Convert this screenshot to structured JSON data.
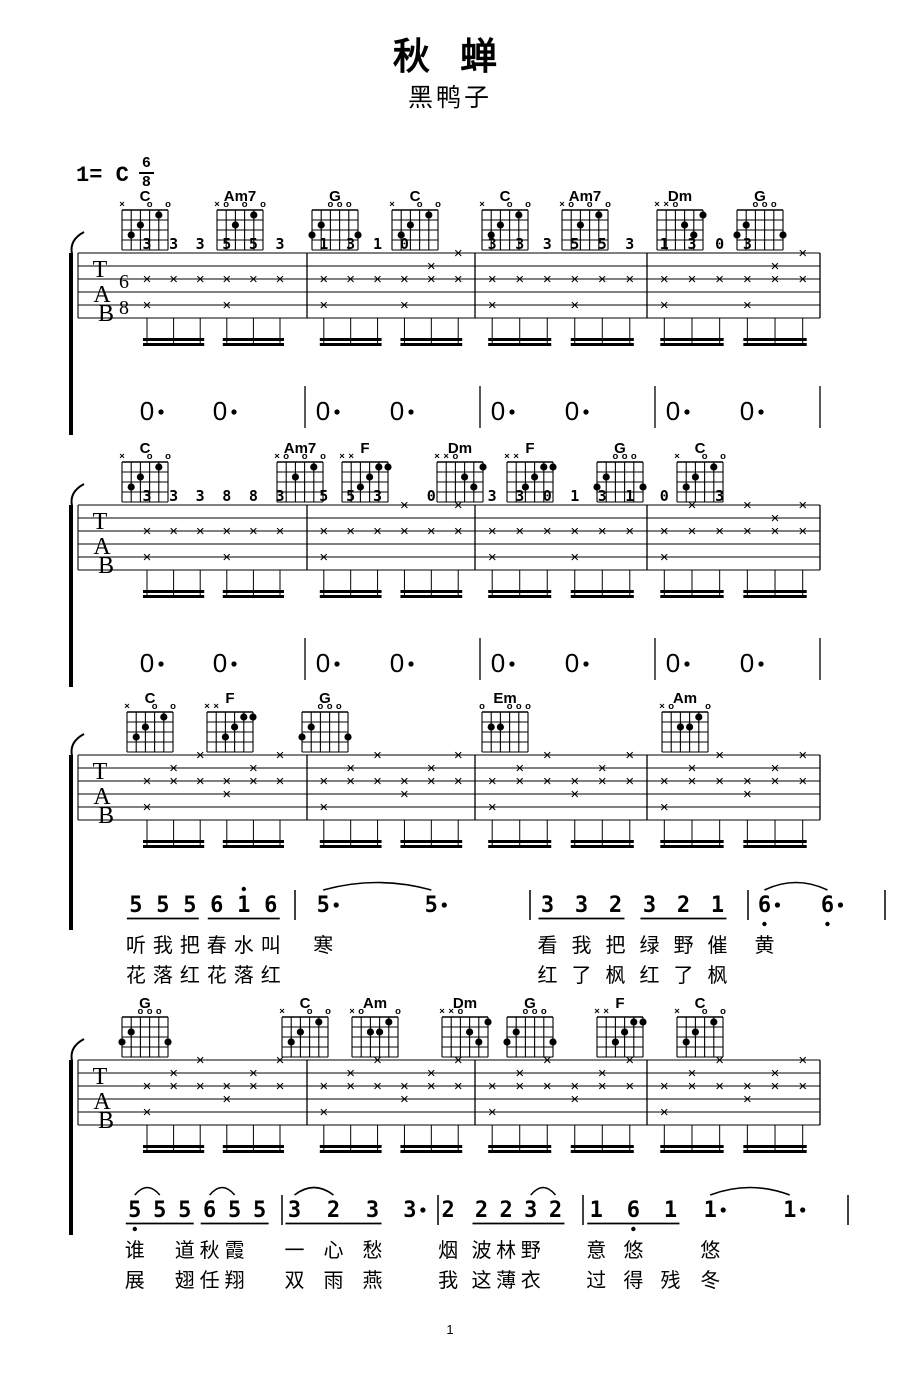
{
  "title": "秋 蝉",
  "artist": "黑鸭子",
  "key": {
    "prefix": "1= C",
    "time_numerator": "6",
    "time_denominator": "8"
  },
  "staff_labels": [
    "T",
    "A",
    "B"
  ],
  "strum_glyph": "×",
  "page_number": "1",
  "colors": {
    "ink": "#000000",
    "paper": "#ffffff"
  },
  "chord_shapes": {
    "C": {
      "markers": [
        "x",
        "",
        "",
        "o",
        "",
        "o"
      ],
      "dots": [
        [
          2,
          3
        ],
        [
          3,
          2
        ],
        [
          5,
          1
        ]
      ]
    },
    "Am7": {
      "markers": [
        "x",
        "o",
        "",
        "o",
        "",
        "o"
      ],
      "dots": [
        [
          3,
          2
        ],
        [
          5,
          1
        ]
      ]
    },
    "G": {
      "markers": [
        "",
        "",
        "o",
        "o",
        "o",
        ""
      ],
      "dots": [
        [
          1,
          3
        ],
        [
          2,
          2
        ],
        [
          6,
          3
        ]
      ]
    },
    "Dm": {
      "markers": [
        "x",
        "x",
        "o",
        "",
        "",
        ""
      ],
      "dots": [
        [
          4,
          2
        ],
        [
          5,
          3
        ],
        [
          6,
          1
        ]
      ]
    },
    "F": {
      "markers": [
        "x",
        "x",
        "",
        "",
        "",
        ""
      ],
      "dots": [
        [
          3,
          3
        ],
        [
          4,
          2
        ],
        [
          5,
          1
        ],
        [
          6,
          1
        ]
      ]
    },
    "Em": {
      "markers": [
        "o",
        "",
        "",
        "o",
        "o",
        "o"
      ],
      "dots": [
        [
          2,
          2
        ],
        [
          3,
          2
        ]
      ]
    },
    "Am": {
      "markers": [
        "x",
        "o",
        "",
        "",
        "",
        "o"
      ],
      "dots": [
        [
          3,
          2
        ],
        [
          4,
          2
        ],
        [
          5,
          1
        ]
      ]
    }
  },
  "systems": [
    {
      "name": "system-1",
      "chords": [
        {
          "name": "C",
          "x": 145
        },
        {
          "name": "Am7",
          "x": 240
        },
        {
          "name": "G",
          "x": 335
        },
        {
          "name": "C",
          "x": 415
        },
        {
          "name": "C",
          "x": 505
        },
        {
          "name": "Am7",
          "x": 585
        },
        {
          "name": "Dm",
          "x": 680
        },
        {
          "name": "G",
          "x": 760
        }
      ],
      "pattern": "arp",
      "digits": [
        [
          "3",
          "3",
          "3",
          "5",
          "5",
          "3"
        ],
        [
          "1",
          "3",
          "1",
          "0",
          "",
          ""
        ],
        [
          "3",
          "3",
          "3",
          "5",
          "5",
          "3"
        ],
        [
          "1",
          "3",
          "0",
          "3",
          "",
          ""
        ]
      ],
      "lower": {
        "type": "rests",
        "symbol": "0·",
        "per_measure": 2
      }
    },
    {
      "name": "system-2",
      "chords": [
        {
          "name": "C",
          "x": 145
        },
        {
          "name": "Am7",
          "x": 300
        },
        {
          "name": "F",
          "x": 365
        },
        {
          "name": "Dm",
          "x": 460
        },
        {
          "name": "F",
          "x": 530
        },
        {
          "name": "G",
          "x": 620
        },
        {
          "name": "C",
          "x": 700
        }
      ],
      "pattern": "arp",
      "digits": [
        [
          "3",
          "3",
          "3",
          "8",
          "8",
          "3"
        ],
        [
          "5",
          "5",
          "3",
          "",
          "0",
          ""
        ],
        [
          "3",
          "3",
          "0",
          "1",
          "3",
          "1"
        ],
        [
          "0",
          "",
          "3",
          "",
          "",
          ""
        ]
      ],
      "lower": {
        "type": "rests",
        "symbol": "0·",
        "per_measure": 2
      }
    },
    {
      "name": "system-3",
      "chords": [
        {
          "name": "C",
          "x": 150
        },
        {
          "name": "F",
          "x": 230
        },
        {
          "name": "G",
          "x": 325
        },
        {
          "name": "Em",
          "x": 505
        },
        {
          "name": "Am",
          "x": 685
        }
      ],
      "pattern": "strum",
      "digits": [
        [],
        [],
        [],
        []
      ],
      "lower": {
        "type": "melody",
        "measures": [
          {
            "notes": [
              "5",
              "5",
              "5",
              "6",
              "1'",
              "6"
            ],
            "under": [
              [
                0,
                2
              ],
              [
                3,
                5
              ]
            ],
            "lyr1": [
              "听",
              "我",
              "把",
              "春",
              "水",
              "叫"
            ],
            "lyr2": [
              "花",
              "落",
              "红",
              "花",
              "落",
              "红"
            ]
          },
          {
            "notes": [
              "5·",
              "5·"
            ],
            "slur": [
              [
                0,
                1
              ]
            ],
            "lyr1": [
              "寒"
            ],
            "lyr2": []
          },
          {
            "notes": [
              "3",
              "3",
              "2",
              "3",
              "2",
              "1"
            ],
            "under": [
              [
                0,
                2
              ],
              [
                3,
                5
              ]
            ],
            "lyr1": [
              "看",
              "我",
              "把",
              "绿",
              "野",
              "催"
            ],
            "lyr2": [
              "红",
              "了",
              "枫",
              "红",
              "了",
              "枫"
            ]
          },
          {
            "notes": [
              "6,·",
              "6,·"
            ],
            "slur": [
              [
                0,
                1
              ]
            ],
            "lyr1": [
              "黄"
            ],
            "lyr2": []
          }
        ]
      }
    },
    {
      "name": "system-4",
      "chords": [
        {
          "name": "G",
          "x": 145
        },
        {
          "name": "C",
          "x": 305
        },
        {
          "name": "Am",
          "x": 375
        },
        {
          "name": "Dm",
          "x": 465
        },
        {
          "name": "G",
          "x": 530
        },
        {
          "name": "F",
          "x": 620
        },
        {
          "name": "C",
          "x": 700
        }
      ],
      "pattern": "strum",
      "digits": [
        [],
        [],
        [],
        []
      ],
      "lower": {
        "type": "melody",
        "measures": [
          {
            "notes": [
              "5,",
              "5",
              "5",
              "6",
              "5",
              "5"
            ],
            "under": [
              [
                0,
                2
              ],
              [
                3,
                5
              ]
            ],
            "slur": [
              [
                0,
                1
              ],
              [
                3,
                4
              ]
            ],
            "lyr1": [
              "谁",
              "道",
              "秋",
              "霞"
            ],
            "lyr1s": [
              0,
              2,
              3,
              4
            ],
            "lyr2": [
              "展",
              "翅",
              "任",
              "翔"
            ],
            "lyr2s": [
              0,
              2,
              3,
              4
            ]
          },
          {
            "notes": [
              "3",
              "2",
              "3",
              "3·"
            ],
            "under": [
              [
                0,
                2
              ]
            ],
            "slur": [
              [
                0,
                1
              ]
            ],
            "lyr1": [
              "一",
              "心",
              "愁"
            ],
            "lyr2": [
              "双",
              "雨",
              "燕"
            ]
          },
          {
            "notes": [
              "2",
              "2",
              "2",
              "3",
              "2"
            ],
            "under": [
              [
                1,
                4
              ]
            ],
            "slur": [
              [
                3,
                4
              ]
            ],
            "lyr1": [
              "烟",
              "波",
              "林",
              "野"
            ],
            "lyr2": [
              "我",
              "这",
              "薄",
              "衣"
            ]
          },
          {
            "notes": [
              "1",
              "6,",
              "1",
              "1·",
              "1·"
            ],
            "under": [
              [
                0,
                2
              ]
            ],
            "slur": [
              [
                3,
                4
              ]
            ],
            "lyr1": [
              "意",
              "悠",
              "悠"
            ],
            "lyr1s": [
              0,
              1,
              3
            ],
            "lyr2": [
              "过",
              "得",
              "残",
              "冬"
            ],
            "lyr2s": [
              0,
              1,
              2,
              3
            ]
          }
        ]
      }
    }
  ]
}
